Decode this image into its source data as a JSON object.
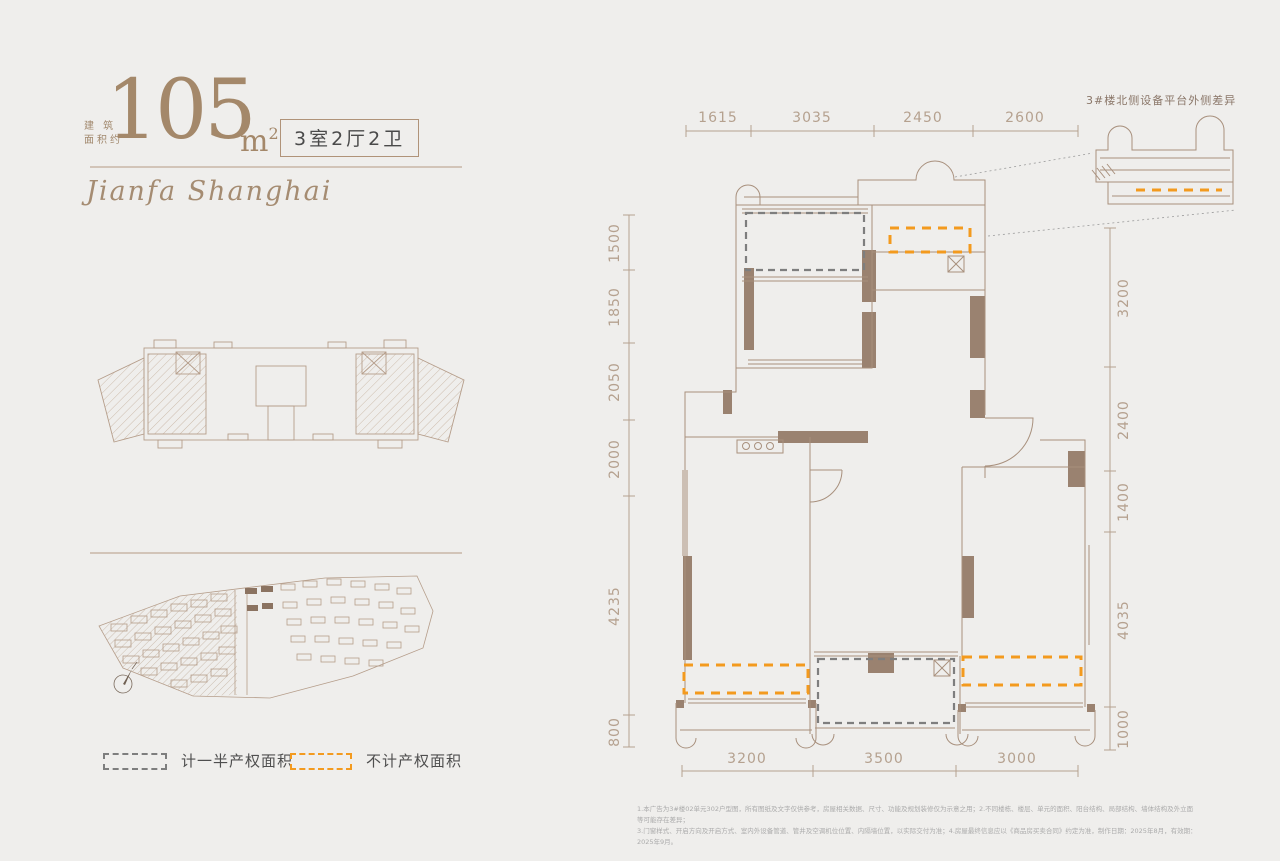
{
  "header": {
    "area_label_line1": "建 筑",
    "area_label_line2": "面积约",
    "area_value": "105",
    "area_unit": "m",
    "area_unit_sup": "2",
    "layout_badge": "3室2厅2卫"
  },
  "brand": {
    "script_text": "Jianfa Shanghai"
  },
  "legend": {
    "half_property_label": "计一半产权面积",
    "non_property_label": "不计产权面积"
  },
  "plan": {
    "note": "3#楼北侧设备平台外侧差异",
    "dims": {
      "top": [
        "1615",
        "3035",
        "2450",
        "2600"
      ],
      "left": [
        "1500",
        "1850",
        "2050",
        "2000",
        "4235",
        "800"
      ],
      "right": [
        "3200",
        "2400",
        "1400",
        "4035",
        "1000"
      ],
      "bottom": [
        "3200",
        "3500",
        "3000"
      ]
    }
  },
  "disclaimer": {
    "line1": "1.本广告为3#楼02单元302户型图，所有图纸及文字仅供参考，房屋相关数据、尺寸、功能及规划装修仅为示意之用；2.不同楼栋、楼层、单元的面积、阳台结构、局部结构、墙体结构及外立面等可能存在差异；",
    "line2": "3.门窗样式、开启方向及开启方式、室内外设备管道、管井及空调机位位置、内隔墙位置，以实际交付为准；4.房屋最终信息应以《商品房买卖合同》约定为准，制作日期：2025年8月，有效期：2025年9月。"
  },
  "colors": {
    "background": "#EFEEEC",
    "line_brown": "#A8907D",
    "wall_fill": "#9A8270",
    "accent_bronze": "#A4886A",
    "dash_gray": "#7E7E7E",
    "dash_orange": "#F39A1E",
    "dim_text": "#B5A18F"
  }
}
